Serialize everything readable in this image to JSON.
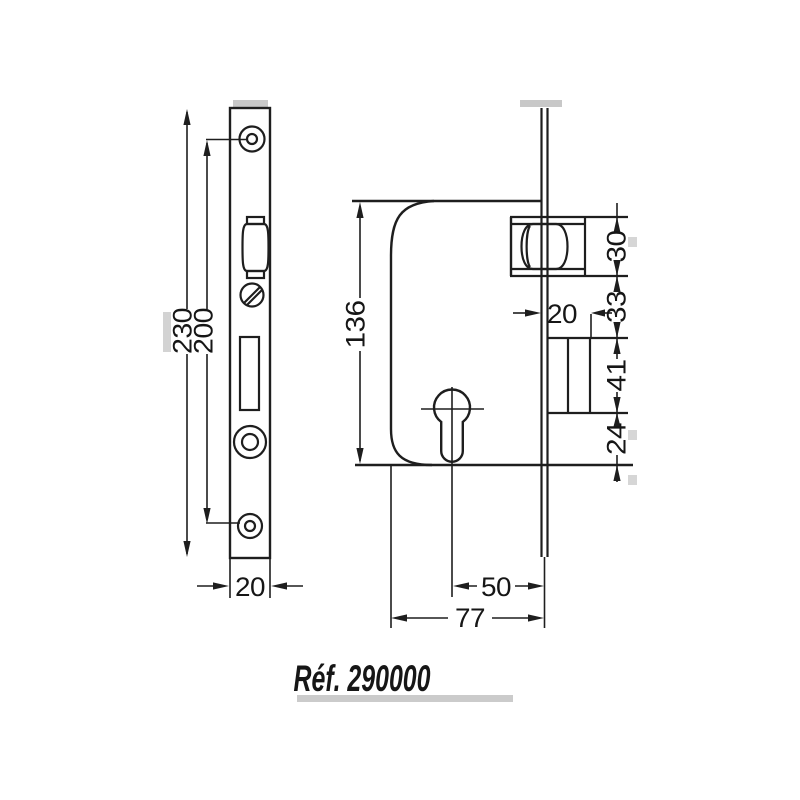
{
  "drawing": {
    "reference_label": "Réf. 290000",
    "faceplate_view": {
      "dimensions": {
        "total_height": "230",
        "screw_hole_spacing": "200",
        "plate_width": "20"
      }
    },
    "case_view": {
      "dimensions": {
        "case_height": "136",
        "deadbolt_throw": "20",
        "latch_housing_height": "30",
        "latch_to_deadbolt_gap": "33",
        "deadbolt_guide_height": "41",
        "deadbolt_to_case_bottom": "24",
        "backset": "50",
        "case_depth": "77"
      }
    }
  },
  "colors": {
    "line": "#1e1e1e",
    "text": "#141414",
    "background": "#ffffff",
    "scan_artifact": "#b5b5b5"
  }
}
